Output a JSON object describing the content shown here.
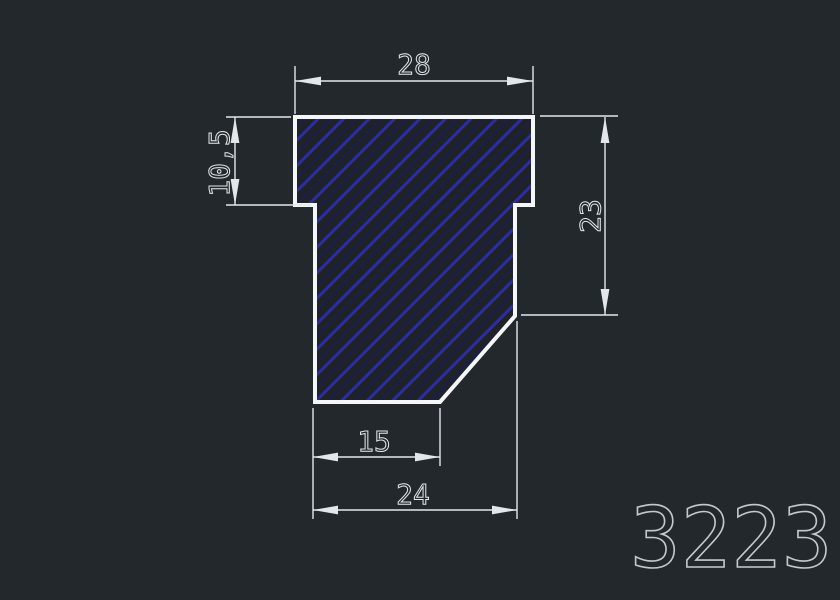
{
  "colors": {
    "bg": "#23282d",
    "fill": "#1f2327",
    "hatchStrong": "#2b2ca6",
    "hatchFaint": "#1a1b60",
    "outline": "#f4f6f7",
    "dim": "#e3e7ea",
    "part": "#c4c9ce"
  },
  "drawing": {
    "type": "cad-profile-cross-section",
    "part_number": "3223",
    "dimensions": {
      "top_width": "28",
      "left_height": "10,5",
      "right_height": "23",
      "bottom_inner_width": "15",
      "bottom_outer_width": "24"
    }
  }
}
